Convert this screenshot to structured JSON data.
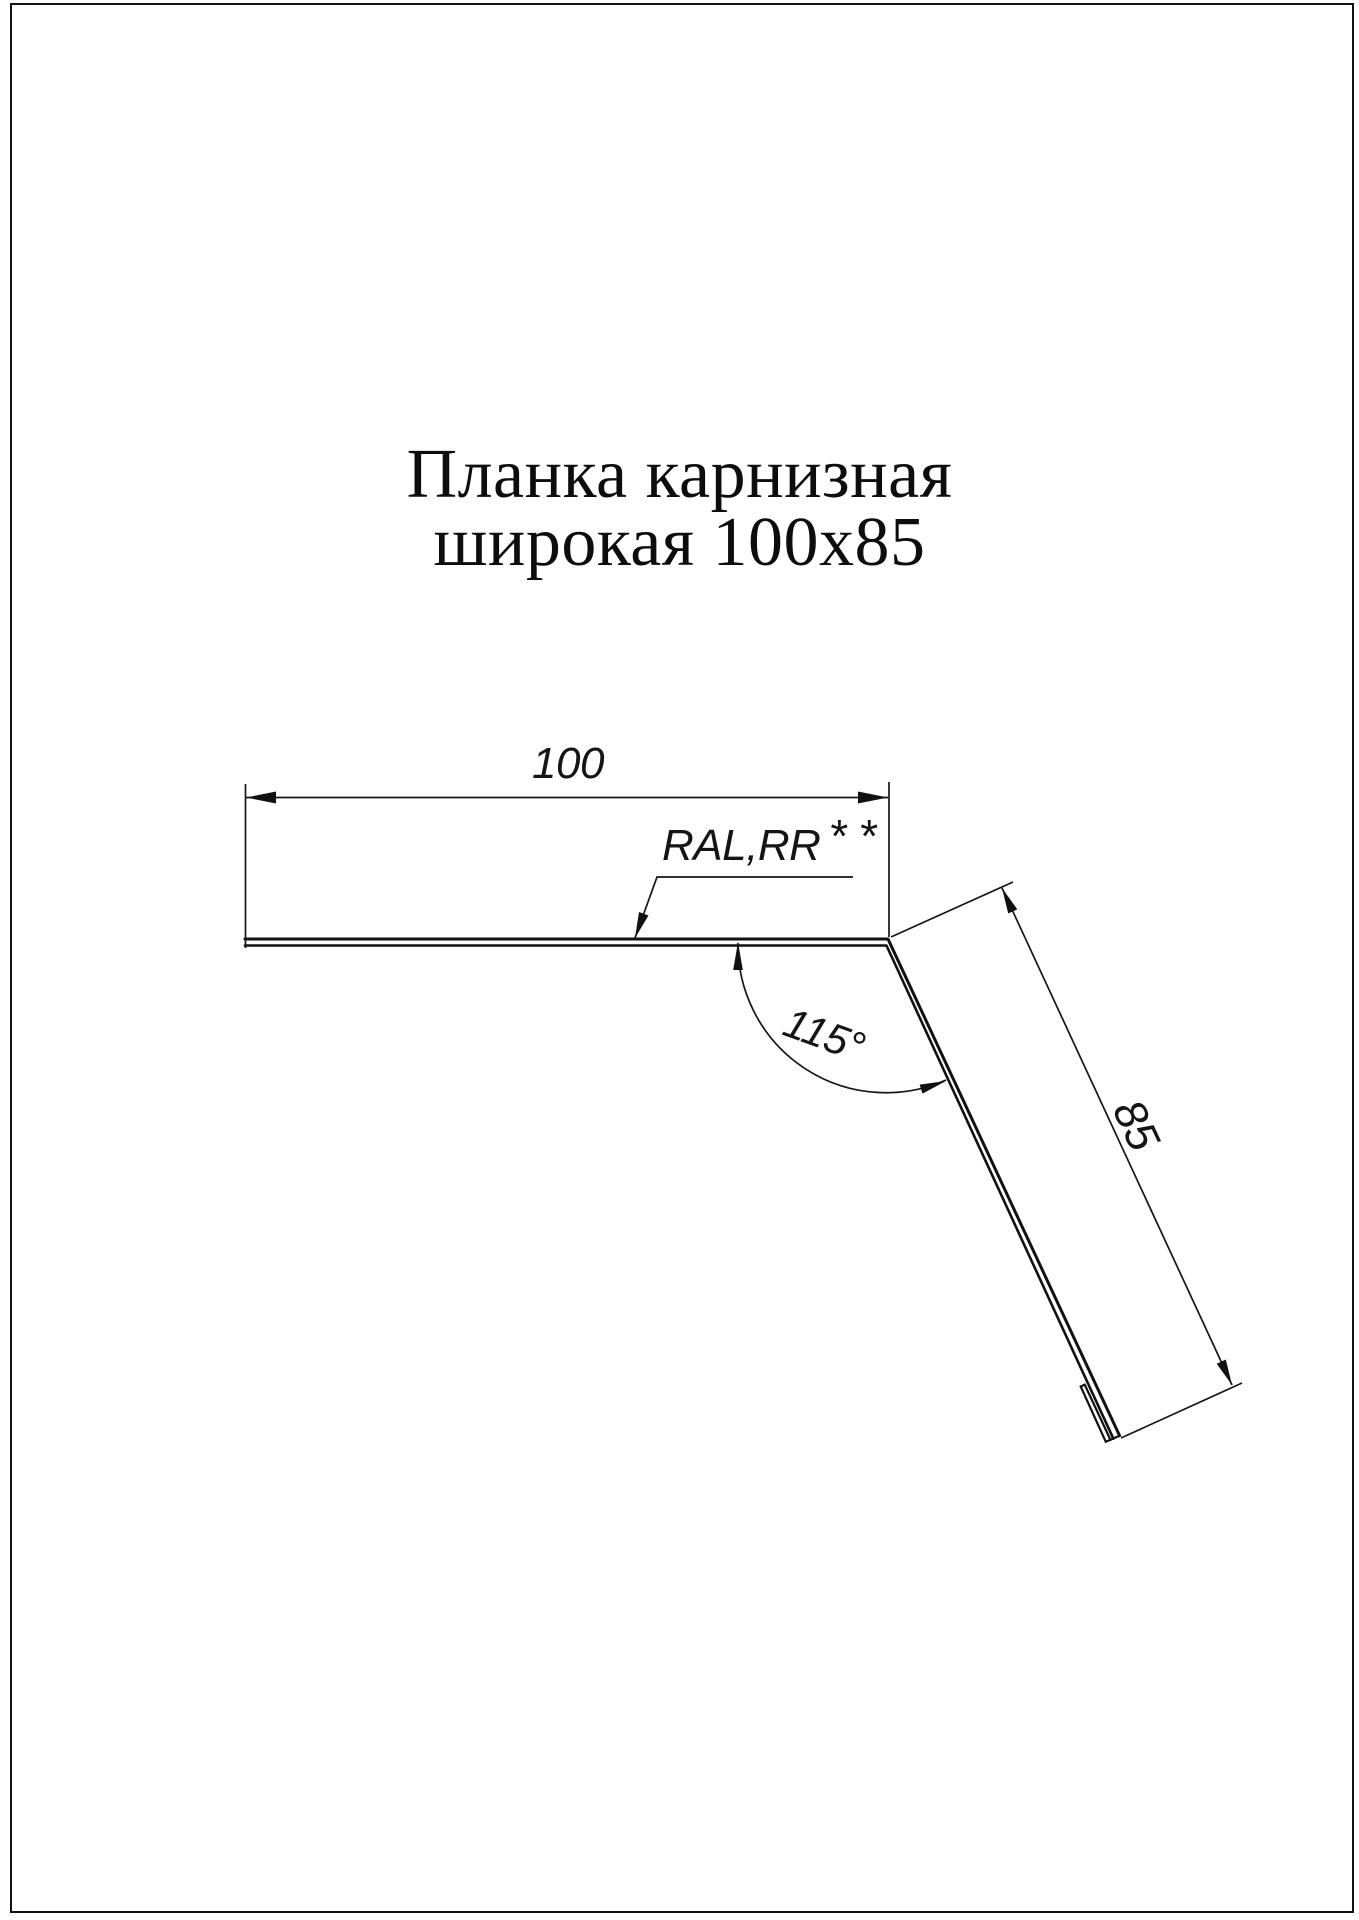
{
  "page": {
    "background": "#ffffff",
    "line_color": "#111111"
  },
  "title": {
    "line1": "Планка карнизная",
    "line2": "широкая 100х85"
  },
  "drawing": {
    "width_dim": "100",
    "length_dim": "85",
    "angle_dim": "115°",
    "coating_note": "RAL,RR",
    "coating_note_stars": "**"
  }
}
